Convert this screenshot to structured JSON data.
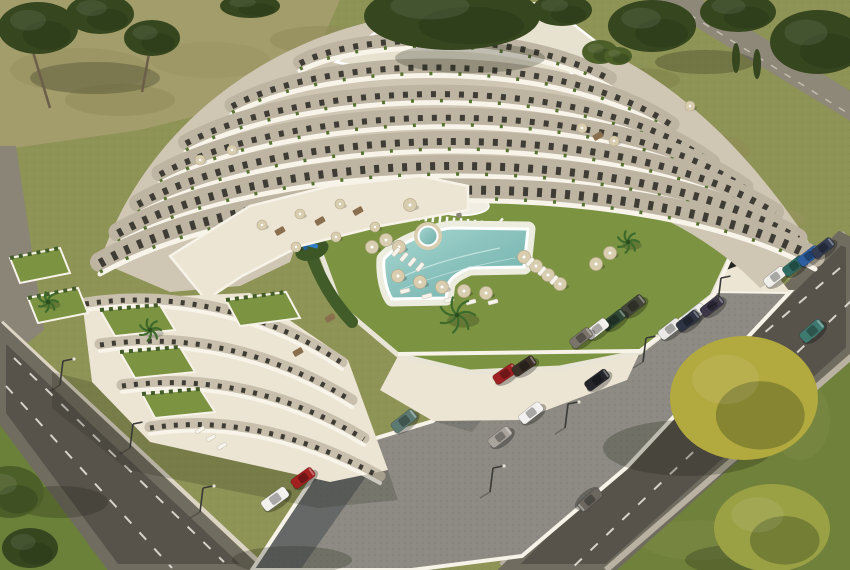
{
  "meta": {
    "title": "Aerial 3D rendering of a white terraced apartment complex",
    "alt": "Aerial render: curved white terraced apartment building around a courtyard with green lawn, L-shaped pool, spa, parasols and palm trees; cobbled parking lot with cars; two roads with dashed lane markings; trees and grass around"
  },
  "palette": {
    "grassBase": "#8e9356",
    "grassDry": "#a79e6e",
    "grassBright": "#7c9342",
    "grassDark": "#5f7634",
    "grassBL": "#6b8039",
    "treeDark": "#36461f",
    "treeMid": "#4c5f29",
    "treeYellow": "#b2a93f",
    "treeYellow2": "#9aa044",
    "road": "#57534b",
    "shoulder": "#716c60",
    "roadLight": "#8d8878",
    "lane": "#eceae2",
    "sidewalk": "#cfc8b6",
    "wall": "#f7f3e9",
    "wallShade": "#ddd5c4",
    "cobble": "#8e8b84",
    "cobbleDot": "#7d7a73",
    "cobbleShadow": "#5d5f61",
    "facade": "#bdb4a2",
    "facadeShade": "#cfc6b4",
    "window": "#3e3c34",
    "slab": "#f8f4ea",
    "roof": "#e7e1cf",
    "terrace": "#ece5d3",
    "water": "#9fd2cc",
    "waterDeep": "#6fb0ac",
    "deck": "#ececdf",
    "parasol": "#d9cdaf",
    "lounger": "#f6f4ec",
    "hedge": "#415c28",
    "planter": "#55722f",
    "play": "#2f80c8",
    "playDark": "#1f5fa0",
    "shadow": "#1e2414",
    "trunk": "#6b5f4a"
  },
  "building": {
    "floors": [
      {
        "d": "M300,62 C360,30 520,28 610,78",
        "w": 14
      },
      {
        "d": "M232,105 C330,52 560,48 672,124",
        "w": 15
      },
      {
        "d": "M186,142 C310,76 590,70 712,162",
        "w": 16
      },
      {
        "d": "M160,173 C300,98 610,92 745,187",
        "w": 17
      },
      {
        "d": "M138,203 C290,120 625,115 775,212",
        "w": 18
      },
      {
        "d": "M118,232 C280,142 640,140 798,238",
        "w": 19
      },
      {
        "d": "M100,262 C270,165 650,165 815,257",
        "w": 20
      }
    ],
    "swBands": [
      {
        "d": "M85,303 C170,290 262,308 342,362",
        "w": 11
      },
      {
        "d": "M100,344 C186,331 272,351 352,400",
        "w": 11
      },
      {
        "d": "M122,385 C206,373 290,393 364,438",
        "w": 11
      },
      {
        "d": "M150,427 C228,415 306,435 380,476",
        "w": 11
      }
    ],
    "gardens": [
      "100,310 160,305 175,330 115,336",
      "120,352 180,347 195,372 135,378",
      "142,394 200,389 215,412 155,418",
      "10,258 60,248 70,273 20,283",
      "28,298 78,288 88,313 38,323",
      "226,300 286,292 300,318 240,326"
    ],
    "hedges": [
      "M300,210 C306,248 320,288 352,322",
      "M560,190 C620,200 700,218 738,232"
    ]
  },
  "cars": [
    [
      633,
      306,
      -38,
      "#43453a",
      26,
      12
    ],
    [
      614,
      320,
      -38,
      "#2e4634",
      25,
      11
    ],
    [
      597,
      329,
      -38,
      "#efeeea",
      25,
      11
    ],
    [
      581,
      338,
      -38,
      "#7a746a",
      24,
      11
    ],
    [
      694,
      314,
      -38,
      "#ececea",
      25,
      11
    ],
    [
      712,
      306,
      -38,
      "#3c3648",
      25,
      11
    ],
    [
      670,
      329,
      -38,
      "#e9e8e6",
      25,
      11
    ],
    [
      688,
      321,
      -38,
      "#2e3442",
      25,
      11
    ],
    [
      775,
      277,
      -38,
      "#f0efec",
      24,
      11
    ],
    [
      794,
      266,
      -38,
      "#2f6b62",
      24,
      11
    ],
    [
      809,
      256,
      -38,
      "#2c5ea0",
      24,
      11
    ],
    [
      823,
      248,
      -38,
      "#343c52",
      24,
      11
    ],
    [
      505,
      374,
      -34,
      "#9e2023",
      25,
      11
    ],
    [
      524,
      366,
      -34,
      "#3a2f26",
      25,
      11
    ],
    [
      597,
      380,
      -36,
      "#24262b",
      26,
      11
    ],
    [
      531,
      413,
      -38,
      "#f1f0ee",
      26,
      11
    ],
    [
      500,
      437,
      -38,
      "#a9a49c",
      25,
      11
    ],
    [
      404,
      421,
      -38,
      "#5d7a72",
      27,
      12
    ],
    [
      303,
      478,
      -36,
      "#a32020",
      25,
      11
    ],
    [
      275,
      499,
      -36,
      "#f2f1ee",
      29,
      12
    ],
    [
      590,
      500,
      139,
      "#6b675f",
      27,
      11
    ],
    [
      812,
      331,
      -41,
      "#3f7a70",
      26,
      12
    ]
  ],
  "trees": [
    [
      38,
      28,
      40,
      26,
      "treeDark"
    ],
    [
      100,
      14,
      34,
      20,
      "treeDark"
    ],
    [
      152,
      38,
      28,
      18,
      "treeDark"
    ],
    [
      250,
      6,
      30,
      12,
      "treeDark"
    ],
    [
      452,
      16,
      88,
      34,
      "treeDark"
    ],
    [
      562,
      10,
      30,
      16,
      "treeDark"
    ],
    [
      652,
      26,
      44,
      26,
      "treeDark"
    ],
    [
      738,
      12,
      38,
      20,
      "treeDark"
    ],
    [
      818,
      42,
      48,
      32,
      "treeDark"
    ],
    [
      600,
      52,
      18,
      12,
      "treeMid"
    ],
    [
      618,
      56,
      14,
      9,
      "treeMid"
    ],
    [
      744,
      398,
      74,
      62,
      "treeYellow"
    ],
    [
      772,
      528,
      58,
      44,
      "treeYellow2"
    ],
    [
      10,
      492,
      34,
      26,
      "treeMid"
    ],
    [
      30,
      548,
      28,
      20,
      "treeDark"
    ]
  ],
  "cypresses": [
    [
      736,
      58
    ],
    [
      757,
      64
    ]
  ],
  "trunks": [
    [
      30,
      42,
      50,
      108
    ],
    [
      150,
      48,
      142,
      92
    ],
    [
      738,
      455,
      744,
      402
    ],
    [
      772,
      566,
      775,
      530
    ]
  ],
  "lamps": [
    [
      718,
      302
    ],
    [
      643,
      362
    ],
    [
      565,
      428
    ],
    [
      490,
      492
    ],
    [
      60,
      385
    ],
    [
      130,
      448
    ],
    [
      200,
      512
    ]
  ],
  "parasols": [
    [
      386,
      240
    ],
    [
      399,
      247
    ],
    [
      372,
      247
    ],
    [
      398,
      276
    ],
    [
      420,
      282
    ],
    [
      442,
      287
    ],
    [
      464,
      291
    ],
    [
      486,
      293
    ],
    [
      524,
      257
    ],
    [
      536,
      266
    ],
    [
      548,
      275
    ],
    [
      560,
      284
    ],
    [
      596,
      264
    ],
    [
      610,
      253
    ],
    [
      410,
      205
    ]
  ],
  "roofParasols": [
    [
      262,
      225
    ],
    [
      300,
      214
    ],
    [
      340,
      204
    ],
    [
      296,
      247
    ],
    [
      336,
      237
    ],
    [
      375,
      227
    ],
    [
      582,
      128
    ],
    [
      614,
      141
    ],
    [
      690,
      106
    ],
    [
      200,
      160
    ],
    [
      232,
      150
    ]
  ],
  "tables": [
    [
      280,
      231
    ],
    [
      320,
      221
    ],
    [
      358,
      211
    ],
    [
      598,
      136
    ],
    [
      330,
      318
    ],
    [
      298,
      352
    ]
  ],
  "loungers": [
    [
      396,
      252,
      -50
    ],
    [
      404,
      257,
      -50
    ],
    [
      412,
      262,
      -50
    ],
    [
      420,
      267,
      -50
    ],
    [
      405,
      291,
      -15
    ],
    [
      427,
      296,
      -15
    ],
    [
      449,
      300,
      -15
    ],
    [
      471,
      302,
      -15
    ],
    [
      493,
      302,
      -15
    ],
    [
      530,
      262,
      -50
    ],
    [
      542,
      271,
      -50
    ],
    [
      554,
      280,
      -50
    ],
    [
      200,
      430,
      -30
    ],
    [
      211,
      438,
      -30
    ],
    [
      222,
      446,
      -30
    ]
  ],
  "palms": [
    [
      457,
      315,
      18
    ],
    [
      628,
      242,
      11
    ],
    [
      48,
      302,
      10
    ],
    [
      150,
      330,
      11
    ]
  ],
  "blotches": [
    [
      80,
      70,
      70,
      22,
      "#958d5e"
    ],
    [
      210,
      60,
      60,
      18,
      "#9a9162"
    ],
    [
      320,
      40,
      50,
      14,
      "#8f8a58"
    ],
    [
      610,
      120,
      60,
      18,
      "#97935f"
    ],
    [
      700,
      150,
      50,
      16,
      "#8f8c55"
    ],
    [
      760,
      220,
      45,
      14,
      "#97935f"
    ],
    [
      640,
      80,
      40,
      12,
      "#7d8148"
    ],
    [
      120,
      100,
      55,
      16,
      "#8f8a58"
    ],
    [
      680,
      300,
      40,
      12,
      "#87894f"
    ],
    [
      800,
      420,
      30,
      40,
      "#7d8a46"
    ],
    [
      700,
      540,
      60,
      20,
      "#7d8a46"
    ]
  ],
  "shadowBlobs": [
    [
      95,
      78,
      65,
      16
    ],
    [
      470,
      58,
      75,
      15
    ],
    [
      705,
      62,
      50,
      12
    ],
    [
      688,
      448,
      85,
      28
    ],
    [
      60,
      502,
      48,
      16
    ],
    [
      292,
      560,
      60,
      14
    ],
    [
      745,
      560,
      60,
      16
    ]
  ]
}
